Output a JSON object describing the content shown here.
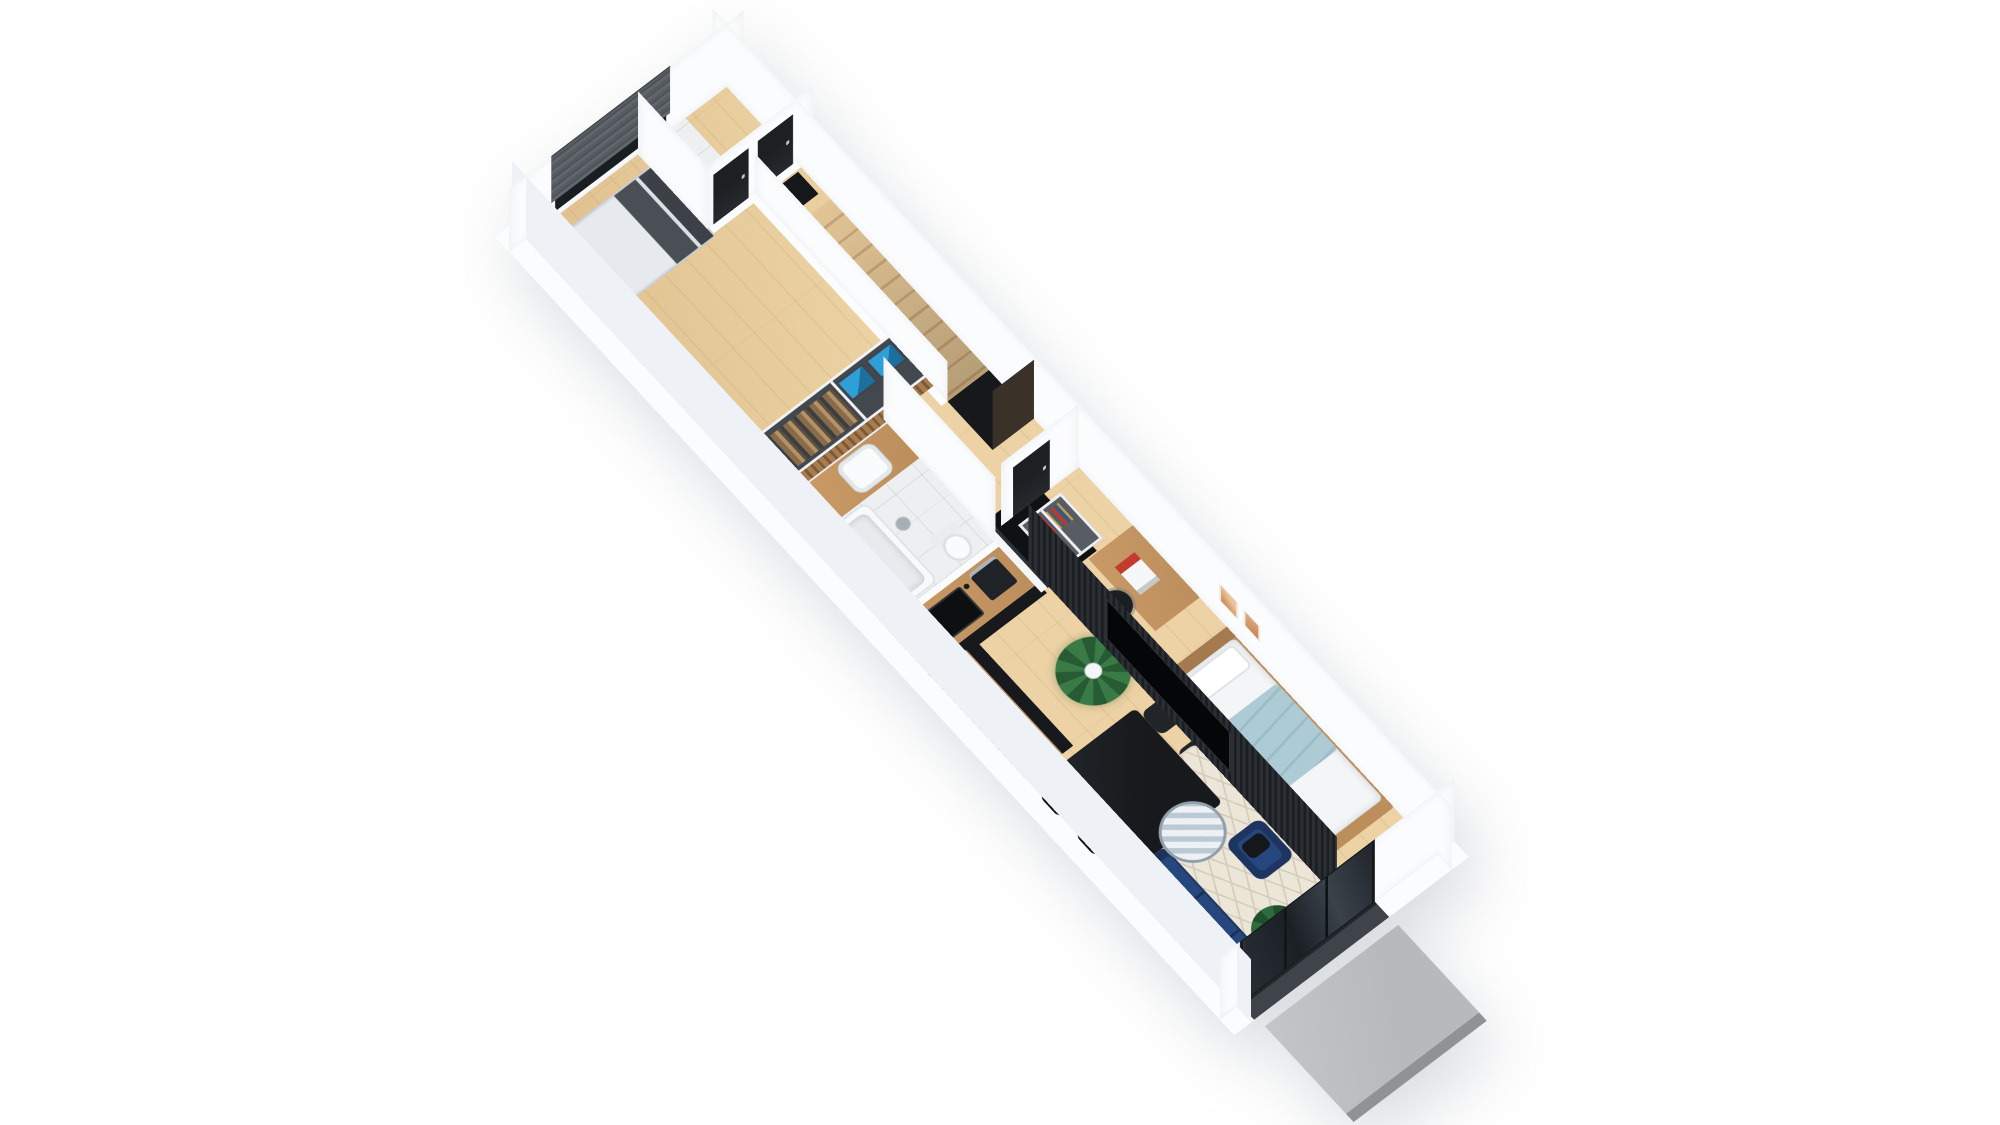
{
  "scene": {
    "title": "3D isometric apartment floor plan render",
    "background": "#ffffff",
    "view": "axonometric top-down, rotated"
  },
  "colors": {
    "wall": "#fbfcfd",
    "wallOuter": "#eef1f5",
    "wood": "#ecd2a4",
    "woodDeep": "#dfc08d",
    "tile": "#edeff1",
    "stair": "#e2c596",
    "stairDark": "#c9a677",
    "dark": "#17191c",
    "doorBlack": "#1d2023",
    "navy": "#26477e",
    "navyDark": "#1d3560",
    "counter": "#bc8e5c",
    "rug": "#ece6d8",
    "rugLine": "#d2cab6",
    "blind": "#565b61",
    "concrete": "#b6babd",
    "concreteEdge": "#8f9396",
    "slat": "#a87c4f",
    "slatDark": "#7d5a36",
    "partition": "#1a1d21",
    "partitionLight": "#2b2e33",
    "blue": "#2f9fd8",
    "blueDark": "#1d6f9e",
    "green": "#2f6b3c",
    "greenDark": "#1f4f2b",
    "artTan": "#c8824f",
    "blanket": "#accbd4",
    "tub": "#f7f9fa",
    "closet": "#43484e",
    "void": "#17181c",
    "threshold": "#3f444a"
  },
  "rooms": [
    {
      "id": "master-bedroom",
      "floor": "wood"
    },
    {
      "id": "wardrobe-closet",
      "floor": "wood"
    },
    {
      "id": "bathroom",
      "floor": "white-tile"
    },
    {
      "id": "wc",
      "floor": "white-tile"
    },
    {
      "id": "hallway",
      "floor": "wood"
    },
    {
      "id": "staircase",
      "floor": "wood-steps"
    },
    {
      "id": "kitchen",
      "floor": "wood"
    },
    {
      "id": "dining-area",
      "floor": "wood"
    },
    {
      "id": "living-room",
      "floor": "wood"
    },
    {
      "id": "bedroom-2",
      "floor": "wood"
    },
    {
      "id": "entrance-porch",
      "floor": "concrete"
    }
  ],
  "furniture": [
    "double-bed",
    "roman-blind-window",
    "open-wardrobe",
    "blue-storage-boxes",
    "vanity-sink",
    "bathtub",
    "toilet",
    "chrome-bin",
    "kitchen-counter",
    "kitchen-sink",
    "coffee-machine",
    "cooktop",
    "tall-black-cabinet",
    "dining-table",
    "dining-chair",
    "palm-plant",
    "monstera-plant",
    "navy-sofa",
    "navy-armchair",
    "round-coffee-table",
    "diamond-rug",
    "tv-slat-partition",
    "television",
    "desk",
    "office-chair",
    "bookshelf",
    "single-bed",
    "wall-art-frames",
    "black-interior-doors",
    "entry-doormat",
    "wooden-stairs",
    "understairs-door",
    "glass-entry-door",
    "concrete-stoop"
  ]
}
